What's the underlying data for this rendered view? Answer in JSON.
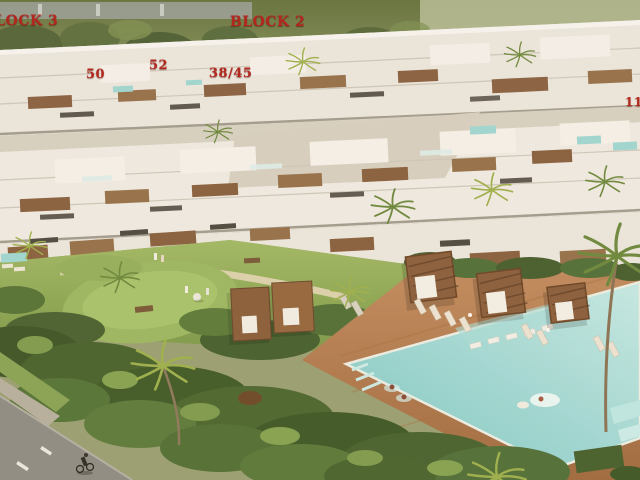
{
  "annotations": {
    "block3": "BLOCK 3",
    "block2": "BLOCK 2",
    "unit50": "50",
    "unit52": "52",
    "unit3845": "38/45",
    "unit11": "11"
  },
  "palette": {
    "label_red": "#b2281f",
    "building_white": "#efece4",
    "wood_brown": "#8a5f3c",
    "pool_water": "#8fd2cf",
    "deck_terracotta": "#b5804f",
    "lawn_green": "#8fae5b",
    "foliage_dark": "#46602f",
    "road_gray": "#8f8e86"
  }
}
